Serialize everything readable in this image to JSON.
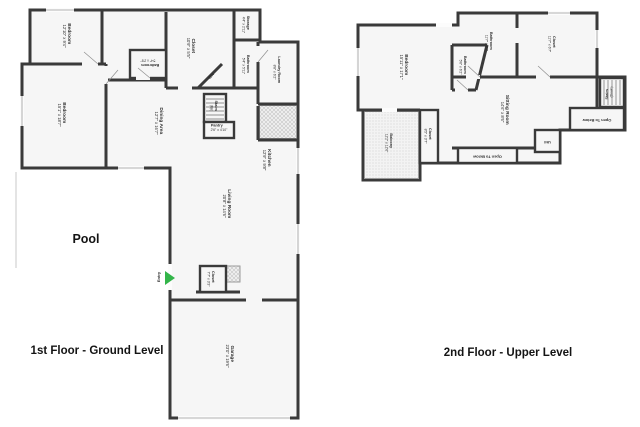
{
  "colors": {
    "wall": "#3a3a3a",
    "room_fill": "#f6f6f6",
    "label_text": "#2e2e2e",
    "entry_arrow": "#33b54a",
    "hatch": "#bbbbbb"
  },
  "floor1": {
    "title": "1st Floor - Ground Level",
    "pool_label": "Pool",
    "entry_label": "Entry",
    "wh_label": "WH",
    "stairs_label": "Stairs",
    "stairs_sub": "(Up)",
    "rooms": [
      {
        "name": "Bedroom",
        "dims": "12'10\" x 9'4\""
      },
      {
        "name": "Bedroom",
        "dims": "15'1\" x 18'7\""
      },
      {
        "name": "Bathroom",
        "dims": "5'4\" x 2'8\""
      },
      {
        "name": "Closet",
        "dims": "10'9\" x 5'5\""
      },
      {
        "name": "Storage",
        "dims": "4'4\" x 2'11\""
      },
      {
        "name": "Bathroom",
        "dims": "5'4\" x 5'11\""
      },
      {
        "name": "Laundry Room",
        "dims": "8'8\" x 6'2\""
      },
      {
        "name": "Dining Area",
        "dims": "12'7\" x 16'7\""
      },
      {
        "name": "Pantry",
        "dims": "2'6\" x 4'10\""
      },
      {
        "name": "Kitchen",
        "dims": "12'9\" x 9'8\""
      },
      {
        "name": "Living Room",
        "dims": "20'8\" x 14'6\""
      },
      {
        "name": "Closet",
        "dims": "7'7\" x 3'3\""
      },
      {
        "name": "Garage",
        "dims": "23'0\" x 19'6\""
      }
    ]
  },
  "floor2": {
    "title": "2nd Floor - Upper Level",
    "stairs_label": "Stairs",
    "stairs_sub": "(Down)",
    "open_below_label": "Open To Below",
    "util_label": "Util",
    "rooms": [
      {
        "name": "Bedroom",
        "dims": "15'11\" x 17'1\""
      },
      {
        "name": "Bathroom",
        "dims": "5'6\" x 6'2\""
      },
      {
        "name": "Bathroom",
        "dims": "11'7\" x 8'2\""
      },
      {
        "name": "Closet",
        "dims": "11'7\" x 6'7\""
      },
      {
        "name": "Sitting Room",
        "dims": "14'6\" x 8'6\""
      },
      {
        "name": "Balcony",
        "dims": "12'2\" x 12'6\""
      },
      {
        "name": "Closet",
        "dims": "8'5\" x 3'7\""
      }
    ]
  }
}
